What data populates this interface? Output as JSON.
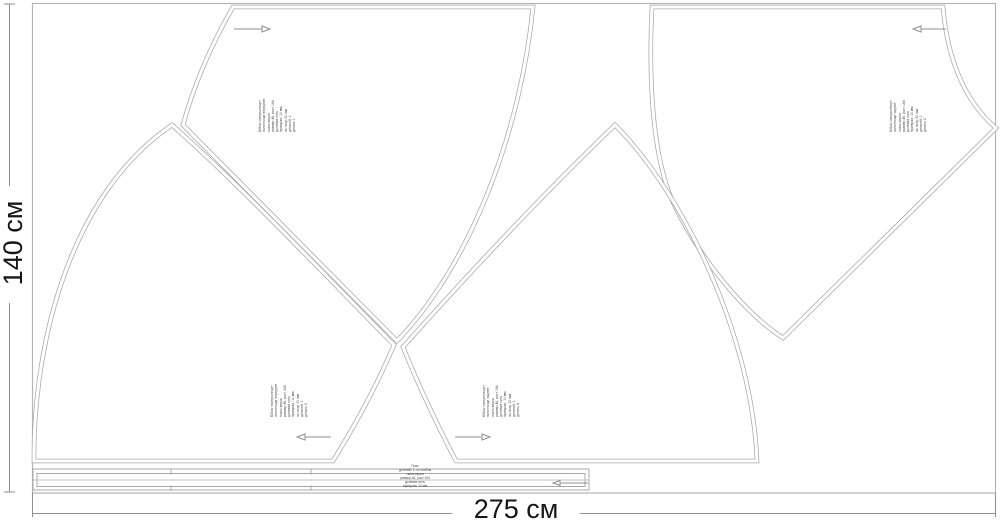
{
  "page": {
    "background": "#ffffff",
    "description": "Раскладка лекал юбки на ткани"
  },
  "dimension_labels": {
    "width": "275 см",
    "height": "140 см"
  },
  "labels": {
    "piece_top_left": "Юбка «полусолнце»\nполотнище переднее\nткань верха\nразмер 46, рост 164\nдолевая нить\nприпуски: 10 мм\nпо низу: 20 мм\nдеталей: 1\nдеталь 1",
    "piece_top_right": "Юбка «полусолнце»\nполотнище заднее\nткань верха\nразмер 46, рост 164\nдолевая нить\nприпуски: 10 мм\nпо низу: 20 мм\nдеталей: 1\nдеталь 2",
    "piece_bottom_left": "Юбка «полусолнце»\nполотнище переднее\nткань верха\nразмер 46, рост 164\nдолевая нить\nприпуски: 10 мм\nпо низу: 20 мм\nдеталей: 1\nдеталь 3",
    "piece_bottom_center": "Юбка «полусолнце»\nполотнище заднее\nткань верха\nразмер 46, рост 164\nдолевая нить\nприпуски: 10 мм\nпо низу: 20 мм\nдеталей: 1\nдеталь 4",
    "waistband": "Пояс\nдеталей: 1, со сгибом\nткань верха\nразмер 46, рост 164\nдолевая нить\nприпуски: 10 мм"
  },
  "colors": {
    "piece_line": "#a8a8a8",
    "fabric_border": "#b5b5b5",
    "dimension_line": "#8f8f8f",
    "dimension_text": "#161616",
    "annotation_text": "#4a4a4a"
  }
}
